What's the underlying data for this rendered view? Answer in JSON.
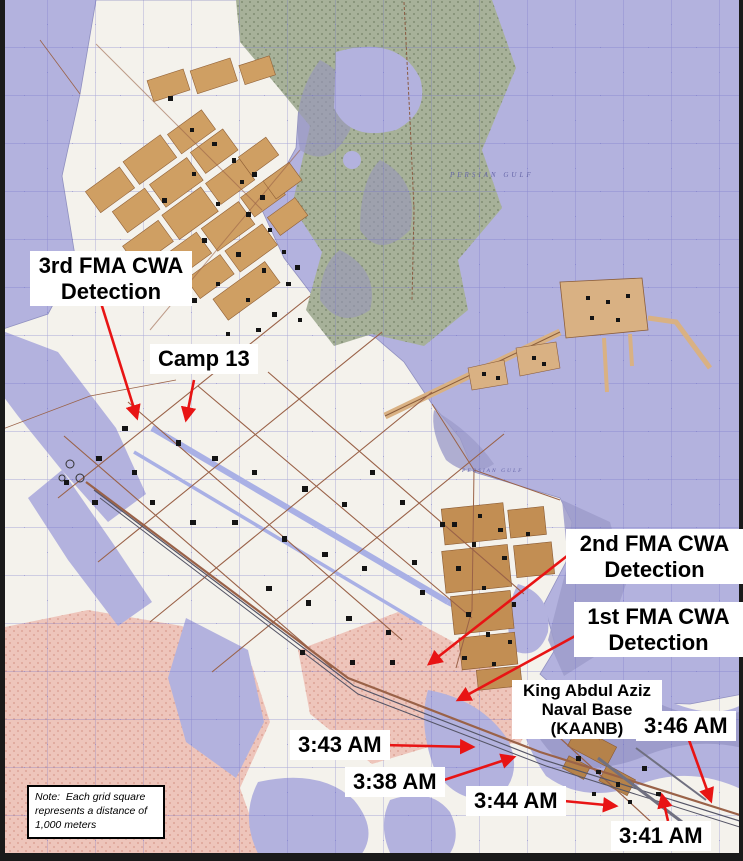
{
  "annotations": {
    "det3": {
      "line1": "3rd FMA CWA",
      "line2": "Detection"
    },
    "camp13": {
      "label": "Camp 13"
    },
    "det2": {
      "line1": "2nd FMA CWA",
      "line2": "Detection"
    },
    "det1": {
      "line1": "1st FMA CWA",
      "line2": "Detection"
    },
    "kaanb": {
      "line1": "King Abdul Aziz",
      "line2": "Naval Base",
      "line3": "(KAANB)"
    },
    "t343": {
      "label": "3:43 AM"
    },
    "t338": {
      "label": "3:38 AM"
    },
    "t344": {
      "label": "3:44 AM"
    },
    "t341": {
      "label": "3:41 AM"
    },
    "t346": {
      "label": "3:46 AM"
    }
  },
  "note": {
    "line1": "Note:  Each grid square",
    "line2": "represents a distance of",
    "line3": "1,000 meters"
  },
  "map_labels": {
    "gulf": "PERSIAN GULF"
  },
  "colors": {
    "arrow_red": "#e81414",
    "water": "#b3b2de",
    "shoal": "#9d9ccb",
    "land": "#f4f2ec",
    "desert": "#eec5bb",
    "tidal_flats": "#a7b199",
    "urban_tan": "#cf9f63",
    "town_brown": "#c28e53",
    "grid_blue": "#6c6cc6",
    "road_brown": "#9a6248",
    "label_bg": "#ffffff",
    "label_text": "#000000"
  }
}
